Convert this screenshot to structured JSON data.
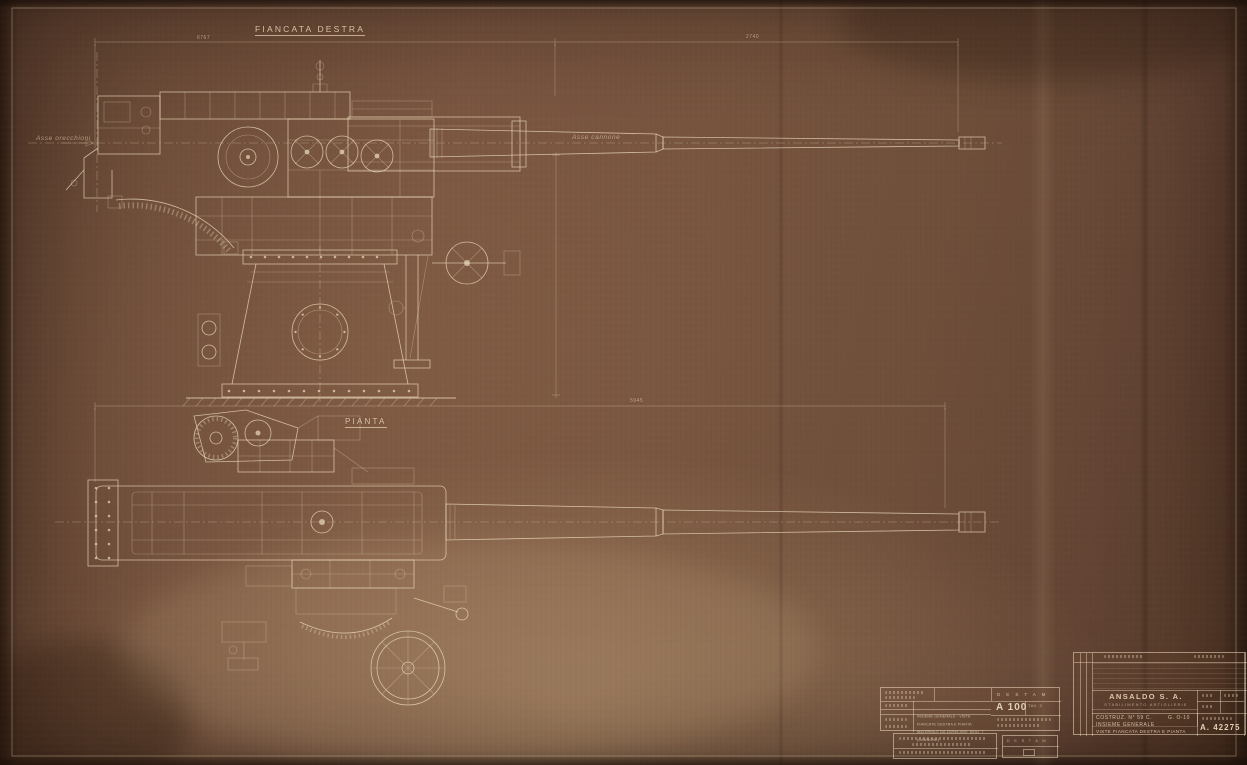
{
  "sheet": {
    "labels": {
      "side_view_title": "FIANCATA DESTRA",
      "plan_view_title": "PIANTA",
      "axis_trunnions": "Asse orecchioni",
      "axis_gun": "Asse cannone"
    },
    "dimensions": {
      "top_left": "6767",
      "top_right": "2740",
      "plan_overall": "5945"
    }
  },
  "title_block": {
    "company": "ANSALDO S. A.",
    "division": "STABILIMENTO ARTIGLIERIE",
    "construction": "COSTRUZ. N° 59 C.",
    "code": "G. O-10",
    "subject_line1": "INSIEME GENERALE",
    "subject_line2": "VISTE FIANCATA DESTRA E PIANTA",
    "drawing_number": "A. 42275"
  },
  "stamp_block": {
    "agency": "D E S T A M",
    "register_number": "A 100",
    "plate": "TAV. 3",
    "desc_line1": "INSIEME GENERALE - VISTE",
    "desc_line2": "FIANCATE DESTRA E PIANTA",
    "desc_line3": "MATERIALE DA 152/45 ANS. MOD. T",
    "desc_line4": "(CANNONE)",
    "bottom_agency": "D E S T A M"
  },
  "colors": {
    "paper": "#74523c",
    "ink": "#ecdabb"
  }
}
